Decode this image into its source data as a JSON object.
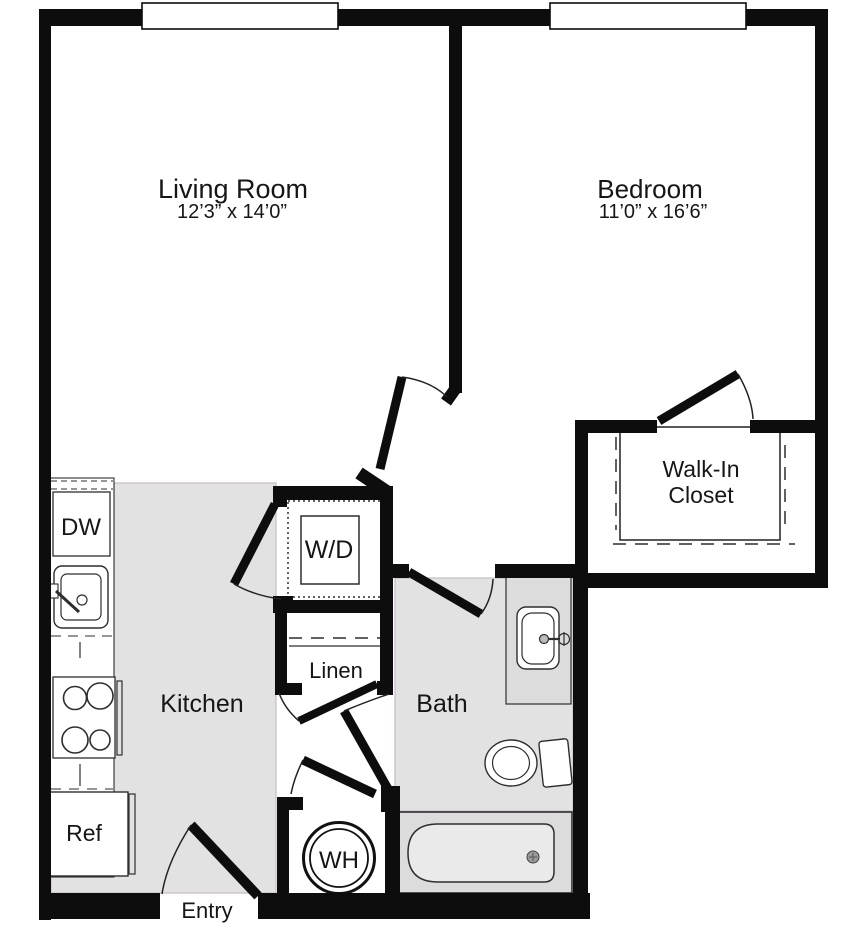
{
  "rooms": {
    "living_room": {
      "label": "Living Room",
      "dims": "12’3” x 14’0”"
    },
    "bedroom": {
      "label": "Bedroom",
      "dims": "11’0” x 16’6”"
    },
    "kitchen": {
      "label": "Kitchen"
    },
    "bath": {
      "label": "Bath"
    },
    "walk_in_closet": {
      "line1": "Walk-In",
      "line2": "Closet"
    },
    "linen": {
      "label": "Linen"
    },
    "entry": {
      "label": "Entry"
    }
  },
  "fixtures": {
    "dishwasher": {
      "label": "DW"
    },
    "washer_dryer": {
      "label": "W/D"
    },
    "water_heater": {
      "label": "WH"
    },
    "refrigerator": {
      "label": "Ref"
    }
  },
  "colors": {
    "wall": "#0d0d0d",
    "floor": "#e2e2e2",
    "fixgray": "#dcdcdc",
    "tubinner": "#eaeaea",
    "line": "#2e2e2e",
    "tint": "#c9bcc7",
    "text": "#161616"
  }
}
